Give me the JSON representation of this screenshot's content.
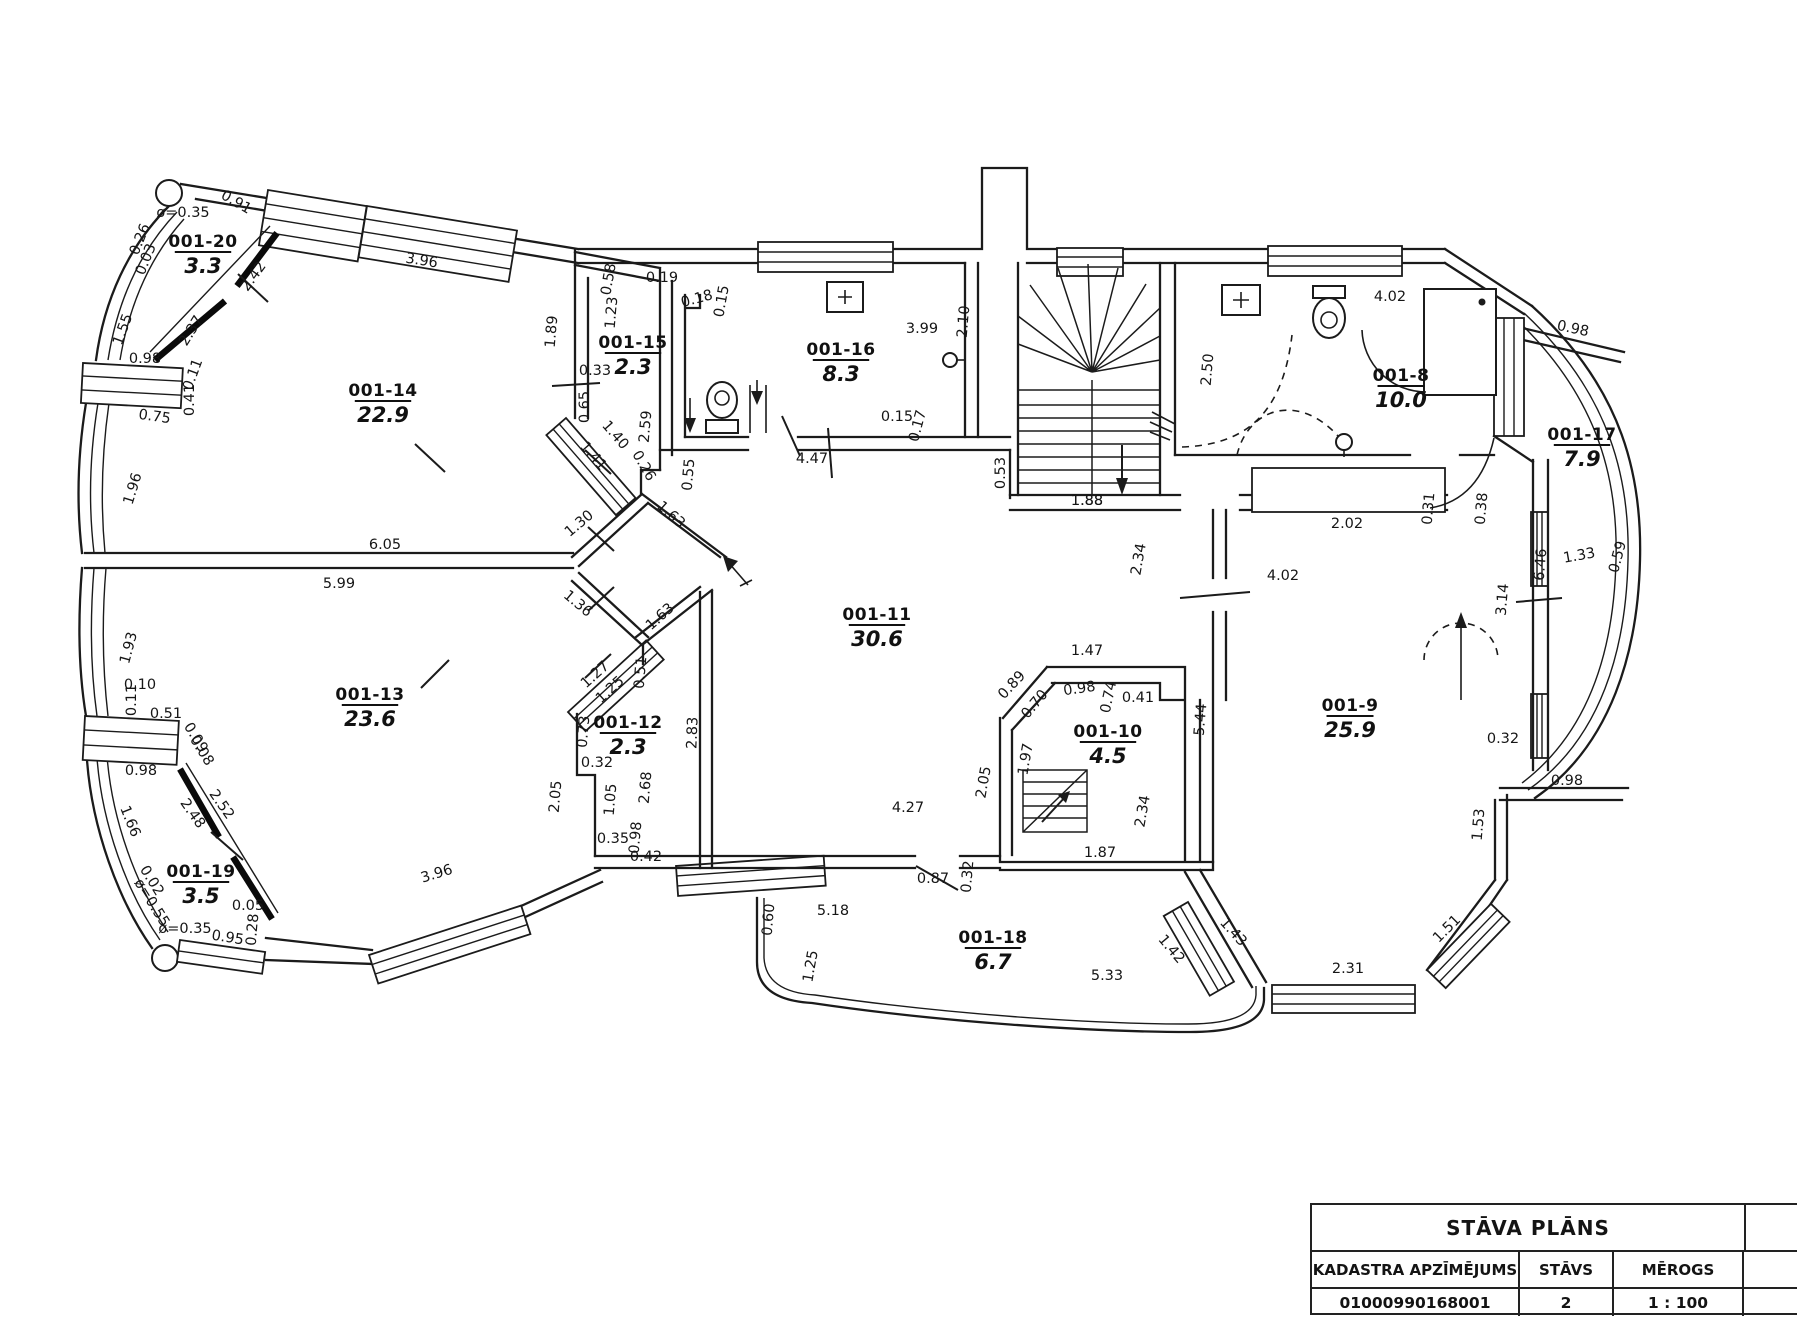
{
  "title_block": {
    "title": "STĀVA PLĀNS",
    "col_headers": [
      "KADASTRA APZĪMĒJUMS",
      "STĀVS",
      "MĒROGS"
    ],
    "values": [
      "01000990168001",
      "2",
      "1 : 100"
    ]
  },
  "plan": {
    "rooms": [
      {
        "id": "001-20",
        "area": "3.3",
        "x": 203,
        "y": 247
      },
      {
        "id": "001-14",
        "area": "22.9",
        "x": 383,
        "y": 396
      },
      {
        "id": "001-15",
        "area": "2.3",
        "x": 633,
        "y": 348
      },
      {
        "id": "001-16",
        "area": "8.3",
        "x": 841,
        "y": 355
      },
      {
        "id": "001-8",
        "area": "10.0",
        "x": 1401,
        "y": 381
      },
      {
        "id": "001-17",
        "area": "7.9",
        "x": 1582,
        "y": 440
      },
      {
        "id": "001-11",
        "area": "30.6",
        "x": 877,
        "y": 620
      },
      {
        "id": "001-13",
        "area": "23.6",
        "x": 370,
        "y": 700
      },
      {
        "id": "001-12",
        "area": "2.3",
        "x": 628,
        "y": 728
      },
      {
        "id": "001-10",
        "area": "4.5",
        "x": 1108,
        "y": 737
      },
      {
        "id": "001-9",
        "area": "25.9",
        "x": 1350,
        "y": 711
      },
      {
        "id": "001-19",
        "area": "3.5",
        "x": 201,
        "y": 877
      },
      {
        "id": "001-18",
        "area": "6.7",
        "x": 993,
        "y": 943
      }
    ],
    "dimensions": [
      {
        "t": "ø=0.35",
        "x": 183,
        "y": 217,
        "r": 0
      },
      {
        "t": "0.91",
        "x": 234,
        "y": 206,
        "r": 30
      },
      {
        "t": "0.26",
        "x": 144,
        "y": 241,
        "r": -68
      },
      {
        "t": "0.03",
        "x": 150,
        "y": 261,
        "r": -68
      },
      {
        "t": "2.42",
        "x": 257,
        "y": 279,
        "r": -54
      },
      {
        "t": "1.55",
        "x": 127,
        "y": 331,
        "r": -70
      },
      {
        "t": "2.37",
        "x": 195,
        "y": 333,
        "r": -58
      },
      {
        "t": "0.98",
        "x": 145,
        "y": 363,
        "r": 0
      },
      {
        "t": "0.11",
        "x": 197,
        "y": 376,
        "r": -70
      },
      {
        "t": "0.41",
        "x": 194,
        "y": 400,
        "r": -90
      },
      {
        "t": "0.75",
        "x": 154,
        "y": 421,
        "r": 8
      },
      {
        "t": "3.96",
        "x": 421,
        "y": 265,
        "r": 9
      },
      {
        "t": "1.89",
        "x": 556,
        "y": 332,
        "r": -85
      },
      {
        "t": "0.58",
        "x": 613,
        "y": 280,
        "r": -80
      },
      {
        "t": "0.19",
        "x": 662,
        "y": 282,
        "r": 0
      },
      {
        "t": "1.23",
        "x": 616,
        "y": 313,
        "r": -85
      },
      {
        "t": "0.33",
        "x": 595,
        "y": 375,
        "r": 0
      },
      {
        "t": "0.65",
        "x": 589,
        "y": 407,
        "r": -90
      },
      {
        "t": "2.59",
        "x": 650,
        "y": 427,
        "r": -85
      },
      {
        "t": "1.40",
        "x": 612,
        "y": 438,
        "r": 49
      },
      {
        "t": "1.41",
        "x": 590,
        "y": 459,
        "r": 49
      },
      {
        "t": "0.26",
        "x": 640,
        "y": 468,
        "r": 60
      },
      {
        "t": "0.18",
        "x": 698,
        "y": 303,
        "r": -15
      },
      {
        "t": "0.15",
        "x": 726,
        "y": 302,
        "r": -80
      },
      {
        "t": "3.99",
        "x": 922,
        "y": 333,
        "r": 0
      },
      {
        "t": "2.10",
        "x": 968,
        "y": 322,
        "r": -85
      },
      {
        "t": "0.15",
        "x": 897,
        "y": 421,
        "r": 0
      },
      {
        "t": "0.17",
        "x": 922,
        "y": 427,
        "r": -75
      },
      {
        "t": "4.47",
        "x": 812,
        "y": 463,
        "r": 0
      },
      {
        "t": "0.55",
        "x": 693,
        "y": 475,
        "r": -85
      },
      {
        "t": "0.53",
        "x": 1005,
        "y": 473,
        "r": -90
      },
      {
        "t": "1.88",
        "x": 1087,
        "y": 505,
        "r": 0
      },
      {
        "t": "2.50",
        "x": 1212,
        "y": 370,
        "r": -85
      },
      {
        "t": "4.02",
        "x": 1390,
        "y": 301,
        "r": 0
      },
      {
        "t": "0.98",
        "x": 1572,
        "y": 333,
        "r": 12
      },
      {
        "t": "2.02",
        "x": 1347,
        "y": 528,
        "r": 0
      },
      {
        "t": "0.31",
        "x": 1433,
        "y": 509,
        "r": -85
      },
      {
        "t": "0.38",
        "x": 1486,
        "y": 509,
        "r": -85
      },
      {
        "t": "6.46",
        "x": 1545,
        "y": 565,
        "r": -85
      },
      {
        "t": "1.33",
        "x": 1580,
        "y": 560,
        "r": -10
      },
      {
        "t": "0.59",
        "x": 1622,
        "y": 558,
        "r": -75
      },
      {
        "t": "3.14",
        "x": 1507,
        "y": 600,
        "r": -85
      },
      {
        "t": "0.32",
        "x": 1503,
        "y": 743,
        "r": 0
      },
      {
        "t": "0.98",
        "x": 1567,
        "y": 785,
        "r": 0
      },
      {
        "t": "1.53",
        "x": 1483,
        "y": 825,
        "r": -85
      },
      {
        "t": "1.51",
        "x": 1450,
        "y": 932,
        "r": -45
      },
      {
        "t": "2.31",
        "x": 1348,
        "y": 973,
        "r": 0
      },
      {
        "t": "1.43",
        "x": 1230,
        "y": 935,
        "r": 48
      },
      {
        "t": "1.42",
        "x": 1168,
        "y": 952,
        "r": 50
      },
      {
        "t": "5.33",
        "x": 1107,
        "y": 980,
        "r": 0
      },
      {
        "t": "1.25",
        "x": 815,
        "y": 967,
        "r": -80
      },
      {
        "t": "0.60",
        "x": 773,
        "y": 920,
        "r": -85
      },
      {
        "t": "5.18",
        "x": 833,
        "y": 915,
        "r": 0
      },
      {
        "t": "0.87",
        "x": 933,
        "y": 883,
        "r": 0
      },
      {
        "t": "0.32",
        "x": 972,
        "y": 877,
        "r": -85
      },
      {
        "t": "3.96",
        "x": 438,
        "y": 878,
        "r": -17
      },
      {
        "t": "0.95",
        "x": 227,
        "y": 942,
        "r": 9
      },
      {
        "t": "0.05",
        "x": 248,
        "y": 910,
        "r": 0
      },
      {
        "t": "0.28",
        "x": 257,
        "y": 930,
        "r": -85
      },
      {
        "t": "ø=0.35",
        "x": 185,
        "y": 933,
        "r": 0
      },
      {
        "t": "ø=0.55",
        "x": 148,
        "y": 905,
        "r": 58
      },
      {
        "t": "0.02",
        "x": 148,
        "y": 883,
        "r": 58
      },
      {
        "t": "1.66",
        "x": 126,
        "y": 823,
        "r": 68
      },
      {
        "t": "2.48",
        "x": 189,
        "y": 816,
        "r": 55
      },
      {
        "t": "2.52",
        "x": 218,
        "y": 807,
        "r": 55
      },
      {
        "t": "0.98",
        "x": 141,
        "y": 775,
        "r": 0
      },
      {
        "t": "0.09",
        "x": 192,
        "y": 740,
        "r": 58
      },
      {
        "t": "0.08",
        "x": 198,
        "y": 753,
        "r": 58
      },
      {
        "t": "0.51",
        "x": 166,
        "y": 718,
        "r": 0
      },
      {
        "t": "0.11",
        "x": 136,
        "y": 700,
        "r": -90
      },
      {
        "t": "0.10",
        "x": 140,
        "y": 689,
        "r": 0
      },
      {
        "t": "1.93",
        "x": 133,
        "y": 649,
        "r": -75
      },
      {
        "t": "1.96",
        "x": 137,
        "y": 490,
        "r": -73
      },
      {
        "t": "6.05",
        "x": 385,
        "y": 549,
        "r": 0
      },
      {
        "t": "5.99",
        "x": 339,
        "y": 588,
        "r": 0
      },
      {
        "t": "1.30",
        "x": 582,
        "y": 527,
        "r": -40
      },
      {
        "t": "1.36",
        "x": 575,
        "y": 607,
        "r": 40
      },
      {
        "t": "1.63",
        "x": 668,
        "y": 518,
        "r": 42
      },
      {
        "t": "1.63",
        "x": 663,
        "y": 620,
        "r": -42
      },
      {
        "t": "1.27",
        "x": 598,
        "y": 678,
        "r": -42
      },
      {
        "t": "1.25",
        "x": 613,
        "y": 693,
        "r": -42
      },
      {
        "t": "0.51",
        "x": 645,
        "y": 673,
        "r": -85
      },
      {
        "t": "0.73",
        "x": 588,
        "y": 732,
        "r": -85
      },
      {
        "t": "0.32",
        "x": 597,
        "y": 767,
        "r": 0
      },
      {
        "t": "2.05",
        "x": 560,
        "y": 797,
        "r": -85
      },
      {
        "t": "1.05",
        "x": 615,
        "y": 800,
        "r": -85
      },
      {
        "t": "2.68",
        "x": 650,
        "y": 788,
        "r": -85
      },
      {
        "t": "0.35",
        "x": 613,
        "y": 843,
        "r": 0
      },
      {
        "t": "0.98",
        "x": 640,
        "y": 838,
        "r": -85
      },
      {
        "t": "0.42",
        "x": 646,
        "y": 861,
        "r": 0
      },
      {
        "t": "2.83",
        "x": 697,
        "y": 733,
        "r": -88
      },
      {
        "t": "4.27",
        "x": 908,
        "y": 812,
        "r": 0
      },
      {
        "t": "2.05",
        "x": 988,
        "y": 783,
        "r": -80
      },
      {
        "t": "1.97",
        "x": 1030,
        "y": 760,
        "r": -80
      },
      {
        "t": "0.70",
        "x": 1038,
        "y": 707,
        "r": -50
      },
      {
        "t": "0.89",
        "x": 1015,
        "y": 688,
        "r": -47
      },
      {
        "t": "0.98",
        "x": 1080,
        "y": 693,
        "r": -8
      },
      {
        "t": "1.47",
        "x": 1087,
        "y": 655,
        "r": 0
      },
      {
        "t": "0.74",
        "x": 1113,
        "y": 698,
        "r": -78
      },
      {
        "t": "0.41",
        "x": 1138,
        "y": 702,
        "r": 0
      },
      {
        "t": "2.34",
        "x": 1147,
        "y": 812,
        "r": -80
      },
      {
        "t": "1.87",
        "x": 1100,
        "y": 857,
        "r": 0
      },
      {
        "t": "5.44",
        "x": 1205,
        "y": 720,
        "r": -85
      },
      {
        "t": "2.34",
        "x": 1143,
        "y": 560,
        "r": -80
      },
      {
        "t": "4.02",
        "x": 1283,
        "y": 580,
        "r": 0
      },
      {
        "t": "1.88",
        "x": 1087,
        "y": 505,
        "r": 0
      }
    ]
  }
}
